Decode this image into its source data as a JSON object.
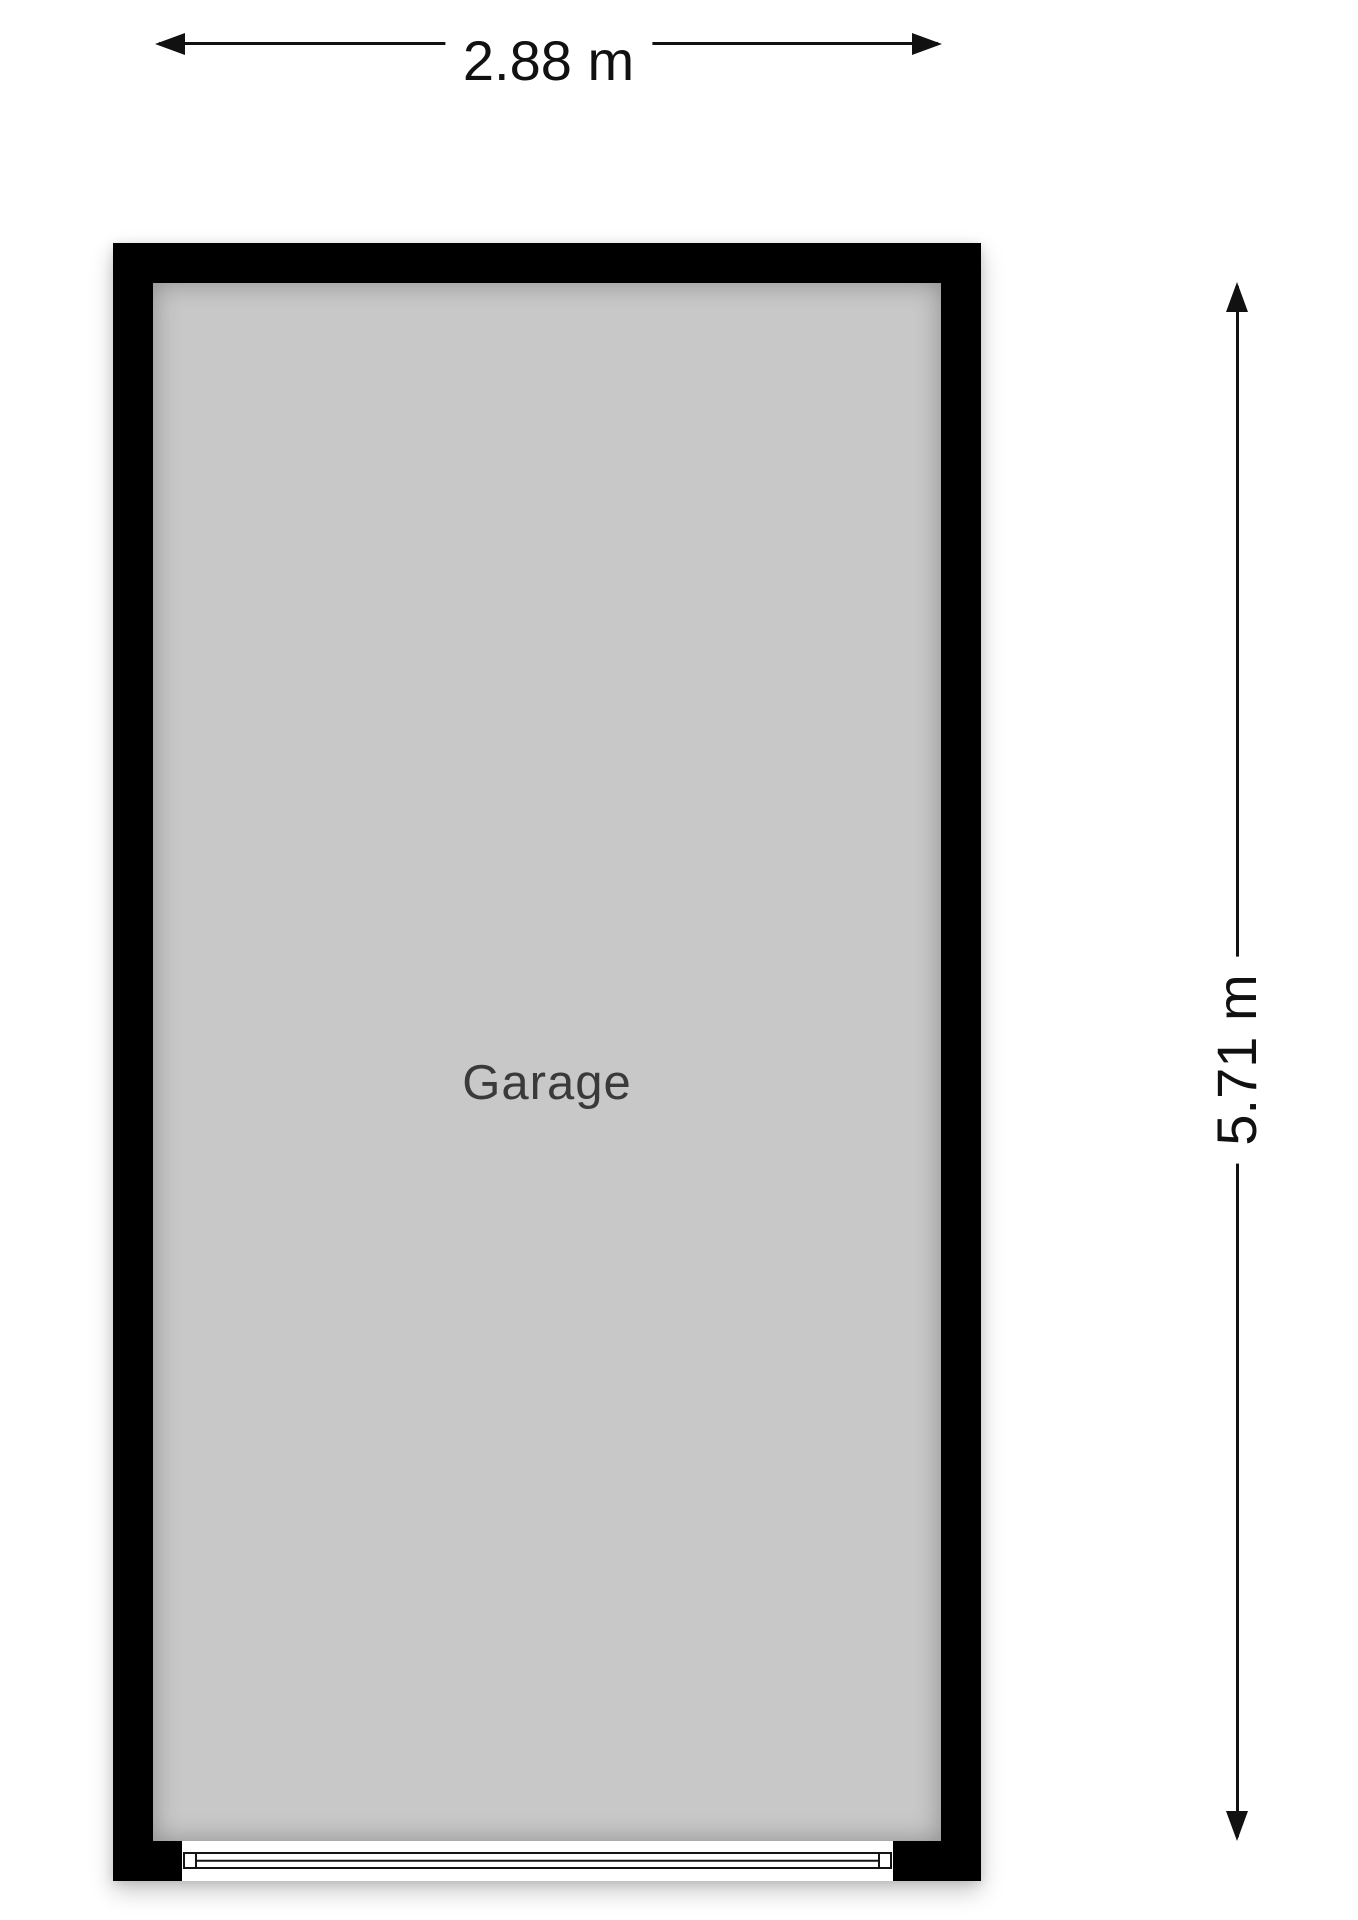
{
  "floorplan": {
    "room": {
      "label": "Garage"
    },
    "dimensions": {
      "width": "2.88 m",
      "height": "5.71 m"
    },
    "icons": {
      "width_arrow": "double-headed-horizontal-arrow",
      "height_arrow": "double-headed-vertical-arrow",
      "door": "garage-door-symbol"
    },
    "colors": {
      "wall": "#000000",
      "floor": "#c8c8c8",
      "dimension_lines": "#111111",
      "room_label_text": "#3a3a3a",
      "background": "#ffffff"
    }
  }
}
